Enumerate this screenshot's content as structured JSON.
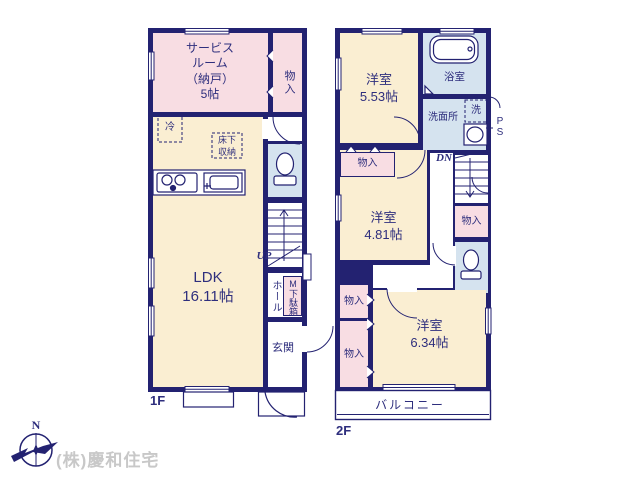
{
  "palette": {
    "wall_navy": "#232271",
    "room_pink": "#f8dde3",
    "room_cream": "#faeed2",
    "wet_area_blue": "#d5e3ef",
    "label_navy": "#2e2e7d",
    "company_gray": "#c8c8c8"
  },
  "floor1": {
    "label": "1F",
    "service_room": "サービス\nルーム\n（納戸）\n5帖",
    "closet": "物入",
    "fridge": "冷",
    "underfloor_storage": "床下\n収納",
    "ldk": "LDK\n16.11帖",
    "up": "UP",
    "hall": "ホール",
    "shoe_box": "M下駄箱",
    "entrance": "玄関"
  },
  "floor2": {
    "label": "2F",
    "room_a": "洋室\n5.53帖",
    "bath": "浴室",
    "washer": "洗",
    "washroom": "洗面所",
    "pipe_space": "P\nS",
    "down": "DN",
    "closet_a": "物入",
    "room_b": "洋室\n4.81帖",
    "closet_d": "物入",
    "closet_b": "物入",
    "closet_c": "物入",
    "room_c": "洋室\n6.34帖",
    "balcony": "バルコニー"
  },
  "footer": {
    "company": "(株)慶和住宅",
    "compass_north": "N"
  }
}
